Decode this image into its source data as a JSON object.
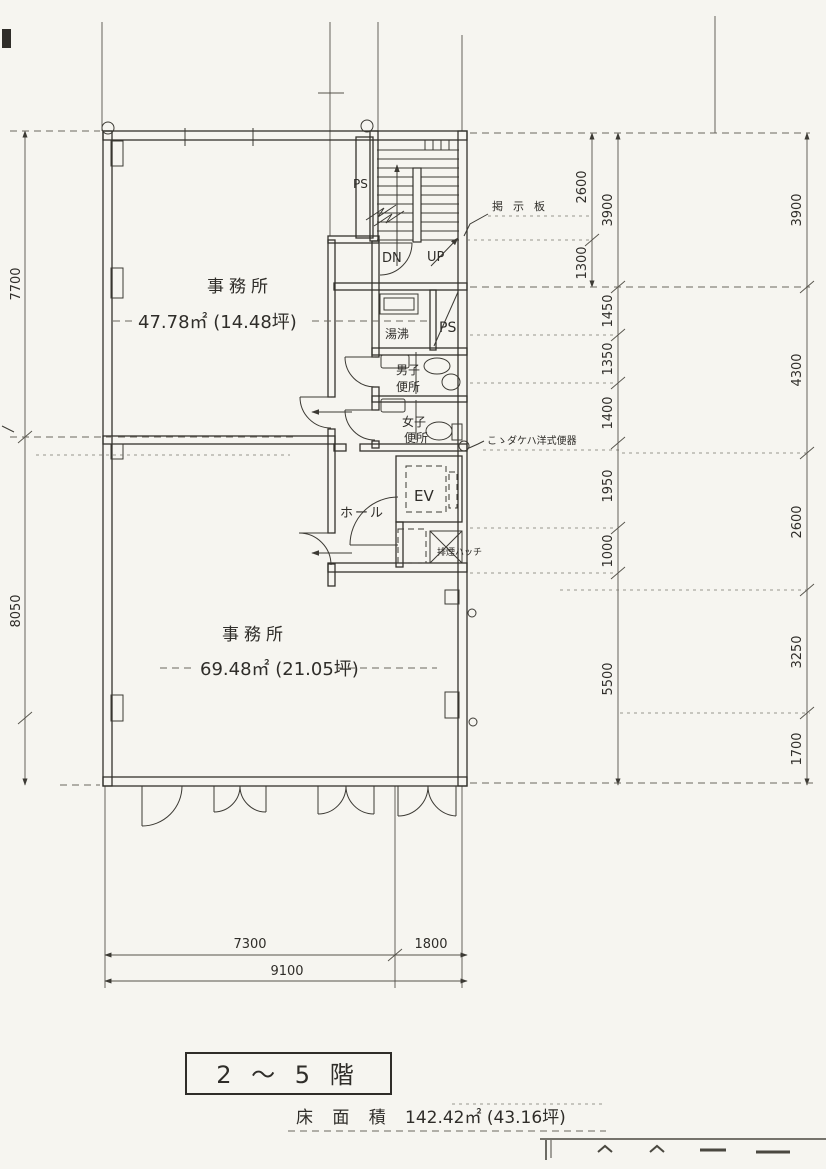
{
  "colors": {
    "paper": "#f6f5f0",
    "ink": "#34322d",
    "dim_ink": "#55524a"
  },
  "rooms": {
    "office_upper": {
      "label": "事務所",
      "area": "47.78㎡ (14.48坪)"
    },
    "office_lower": {
      "label": "事務所",
      "area": "69.48㎡ (21.05坪)"
    },
    "hall": {
      "label": "ホール"
    },
    "elevator": {
      "label": "EV"
    },
    "mens_toilet": {
      "line1": "男子",
      "line2": "便所"
    },
    "womens_toilet": {
      "line1": "女子",
      "line2": "便所"
    },
    "water_heating": {
      "label": "湯沸"
    },
    "pipe_shaft_upper": {
      "label": "PS"
    },
    "pipe_shaft_mid": {
      "label": "PS"
    },
    "stair": {
      "down": "DN",
      "up": "UP"
    },
    "smoke_hatch": {
      "label": "排煙ハッチ"
    }
  },
  "notes": {
    "bulletin_board": "掲示板",
    "western_toilet": "こゝダケハ洋式便器"
  },
  "dims": {
    "left_upper": "7700",
    "left_lower": "8050",
    "inner_a": [
      "2600",
      "1300"
    ],
    "inner_b": [
      "3900",
      "1450",
      "1350",
      "1400",
      "1950",
      "1000",
      "5500"
    ],
    "outer": [
      "3900",
      "4300",
      "2600",
      "3250",
      "1700"
    ],
    "bottom_a": [
      "7300",
      "1800"
    ],
    "bottom_total": "9100"
  },
  "title": {
    "floor_range": "2 ～ 5 階",
    "area_caption": "床 面 積",
    "area_value": "142.42㎡ (43.16坪)"
  }
}
